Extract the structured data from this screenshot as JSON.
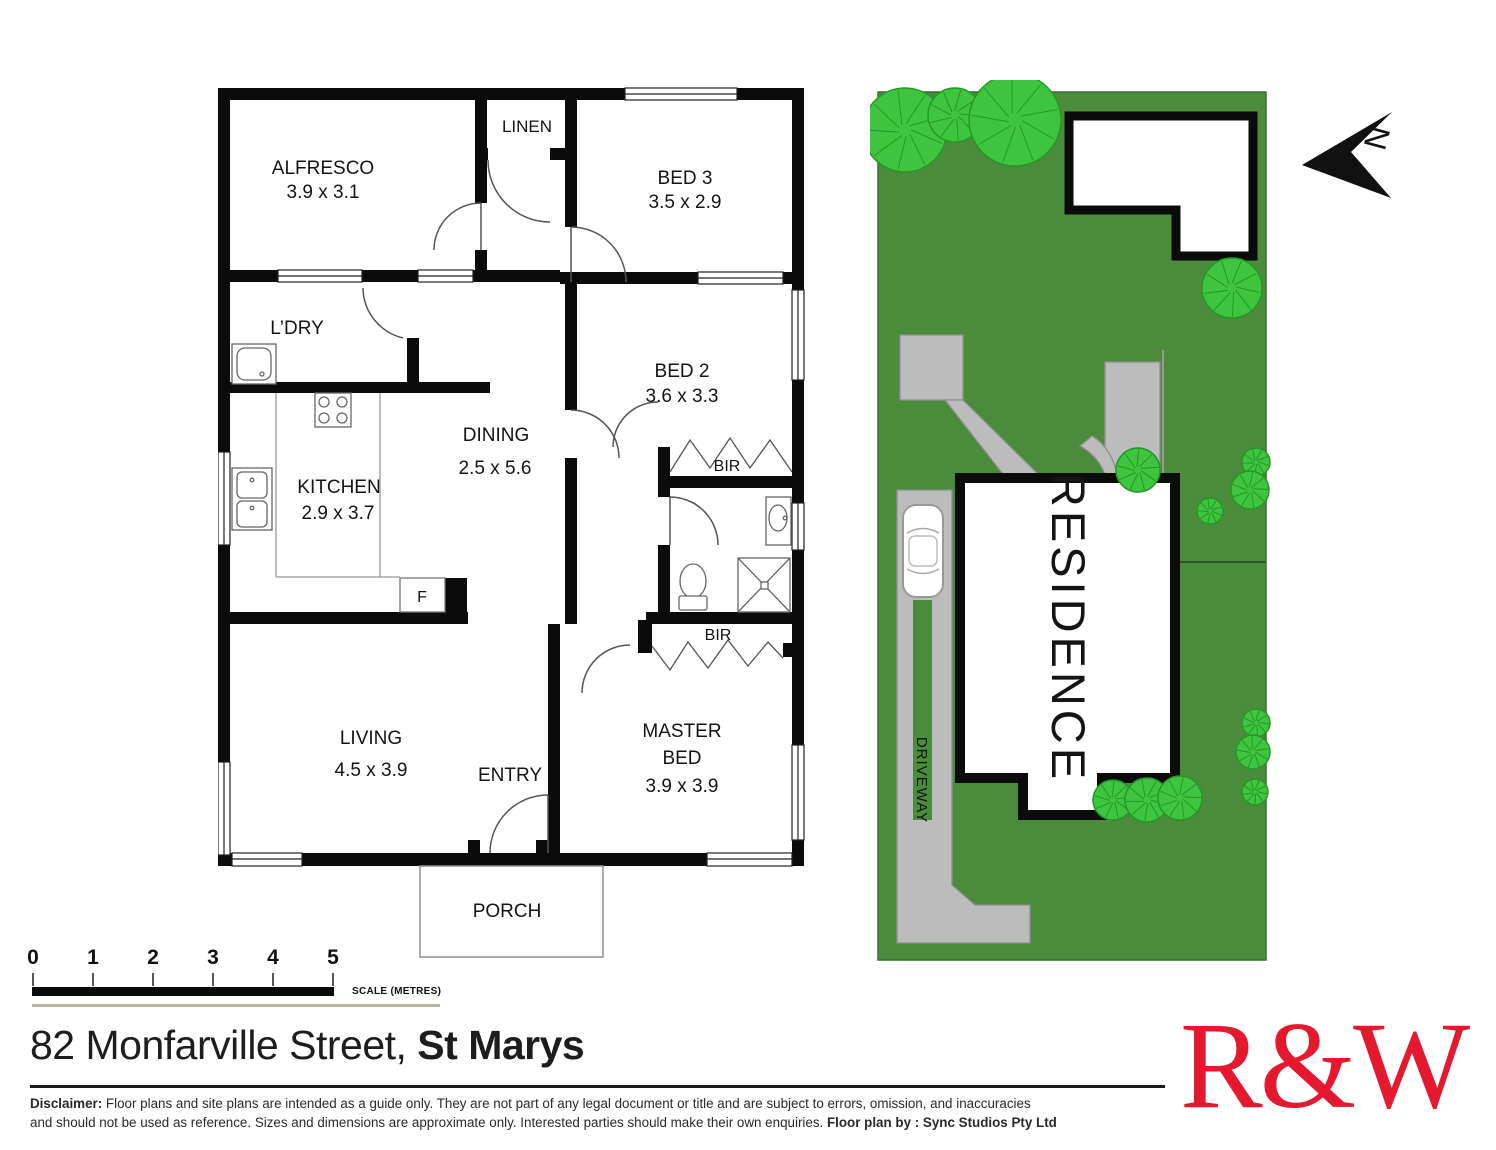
{
  "floor_plan": {
    "labels": {
      "alfresco": "ALFRESCO",
      "alfresco_dims": "3.9 x 3.1",
      "linen": "LINEN",
      "bed3": "BED 3",
      "bed3_dims": "3.5 x 2.9",
      "ldry": "L’DRY",
      "bed2": "BED 2",
      "bed2_dims": "3.6 x 3.3",
      "dining": "DINING",
      "dining_dims": "2.5 x 5.6",
      "kitchen": "KITCHEN",
      "kitchen_dims": "2.9 x 3.7",
      "bir": "BIR",
      "fridge": "F",
      "living": "LIVING",
      "living_dims": "4.5 x 3.9",
      "master1": "MASTER",
      "master2": "BED",
      "master_dims": "3.9 x 3.9",
      "entry": "ENTRY",
      "porch": "PORCH"
    }
  },
  "site_plan": {
    "residence_label": "RESIDENCE",
    "driveway_label": "DRIVEWAY",
    "north_label": "N",
    "colors": {
      "lawn": "#4a8c3b",
      "lawn_border": "#33702c",
      "tree": "#3ec43e",
      "tree_outline": "#259925",
      "paving": "#bcbcbc",
      "paving_border": "#8f8f8f",
      "wall": "#0b0b0b"
    },
    "trees": [
      [
        35,
        50,
        42
      ],
      [
        85,
        35,
        27
      ],
      [
        145,
        40,
        46
      ],
      [
        362,
        208,
        30
      ],
      [
        268,
        390,
        22
      ],
      [
        386,
        382,
        14
      ],
      [
        380,
        410,
        19
      ],
      [
        340,
        431,
        13
      ],
      [
        386,
        643,
        14
      ],
      [
        383,
        672,
        17
      ],
      [
        385,
        712,
        13
      ],
      [
        243,
        720,
        20
      ],
      [
        277,
        720,
        22
      ],
      [
        310,
        718,
        22
      ]
    ]
  },
  "scale": {
    "ticks": [
      "0",
      "1",
      "2",
      "3",
      "4",
      "5"
    ],
    "label": "SCALE (METRES)"
  },
  "footer": {
    "address": "82 Monfarville Street, ",
    "suburb": "St Marys",
    "disclaimer_label": "Disclaimer:",
    "disclaimer_line1": " Floor plans and site plans are intended as a guide only. They are not part of any legal document or title and are subject to errors, omission, and inaccuracies",
    "disclaimer_line2": "and should not be used as reference. Sizes and dimensions are approximate only. Interested parties should make their own enquiries. ",
    "credit": "Floor plan by : Sync Studios Pty Ltd",
    "logo": "R&W"
  }
}
